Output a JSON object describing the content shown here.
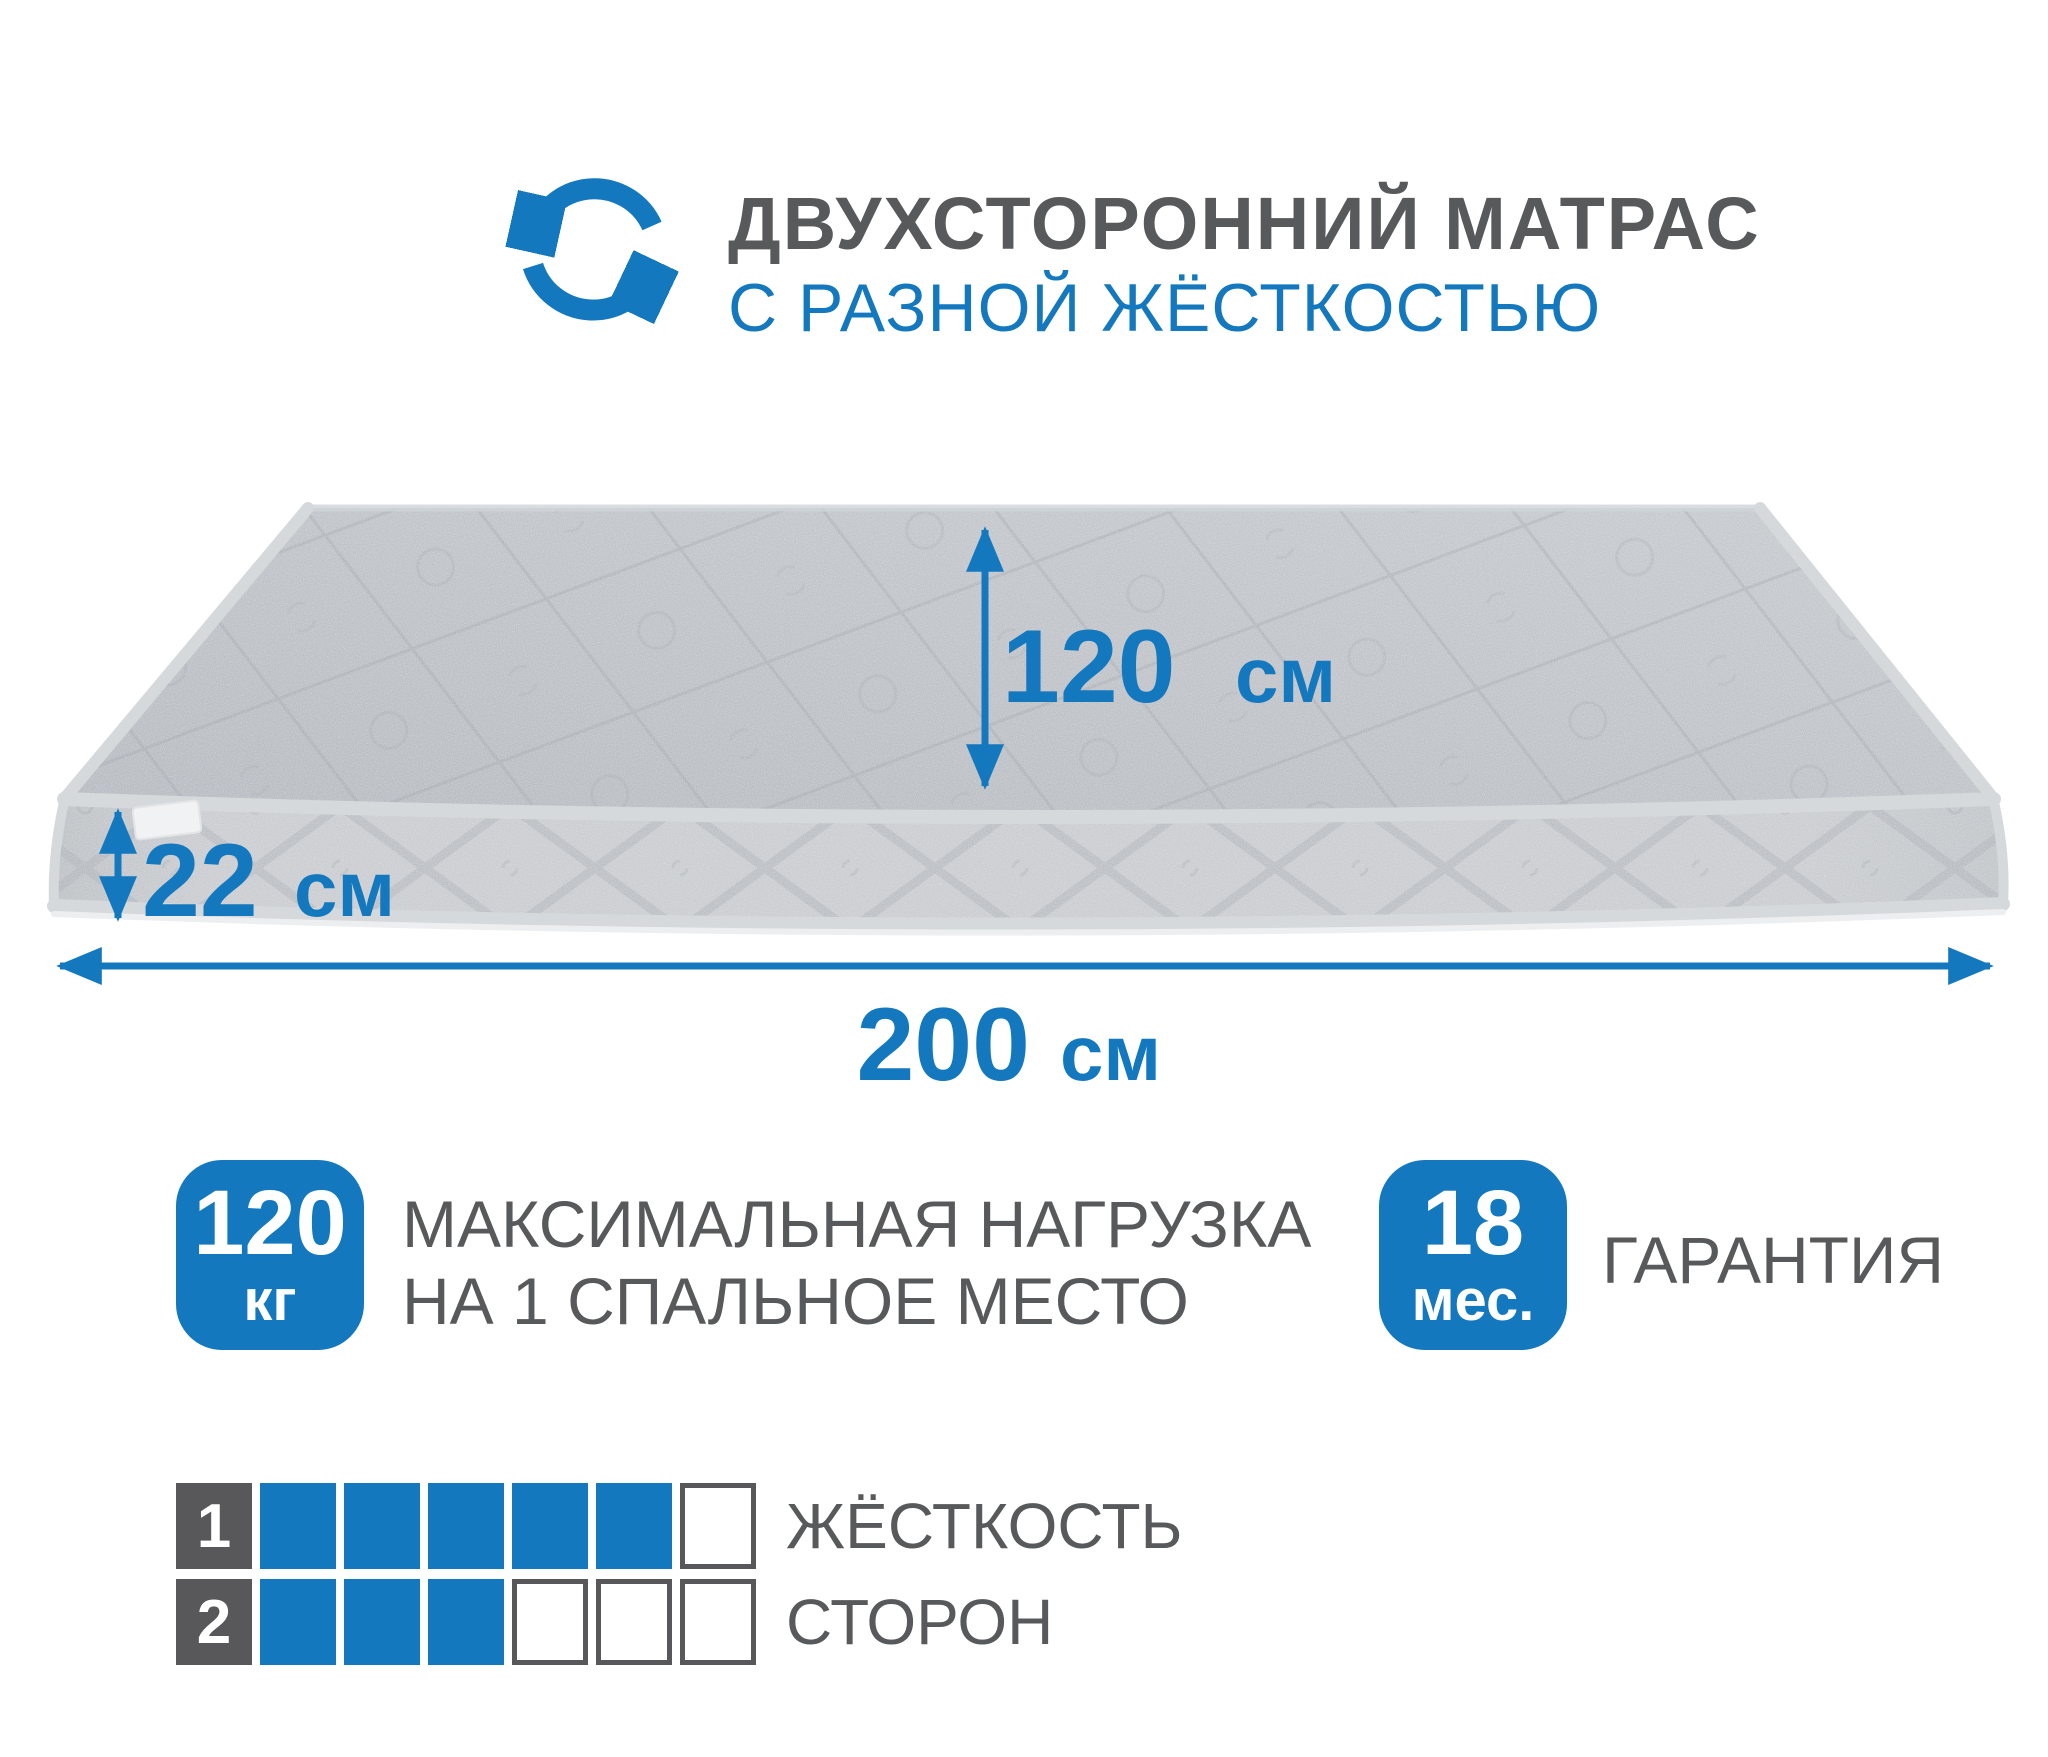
{
  "header": {
    "title": "ДВУХСТОРОННИЙ МАТРАС",
    "subtitle": "С РАЗНОЙ ЖЁСТКОСТЬЮ",
    "icon": "rotation-arrows-icon"
  },
  "dimensions": {
    "width": {
      "value": "120",
      "unit": "см"
    },
    "thickness": {
      "value": "22",
      "unit": "см"
    },
    "length": {
      "value": "200",
      "unit": "см"
    }
  },
  "badges": {
    "max_load": {
      "value": "120",
      "unit": "кг",
      "label_line1": "МАКСИМАЛЬНАЯ НАГРУЗКА",
      "label_line2": "НА 1 СПАЛЬНОЕ МЕСТО"
    },
    "warranty": {
      "value": "18",
      "unit": "мес.",
      "label": "ГАРАНТИЯ"
    }
  },
  "firmness": {
    "label_line1": "ЖЁСТКОСТЬ",
    "label_line2": "СТОРОН",
    "scale_max": 6,
    "sides": [
      {
        "index": "1",
        "filled": 5
      },
      {
        "index": "2",
        "filled": 3
      }
    ]
  },
  "colors": {
    "accent": "#1478be",
    "text_gray": "#58595b",
    "square_gray": "#58585a",
    "mattress_top": "#bdc1c6",
    "mattress_side": "#c7cacd",
    "piping": "#d6d9db"
  }
}
